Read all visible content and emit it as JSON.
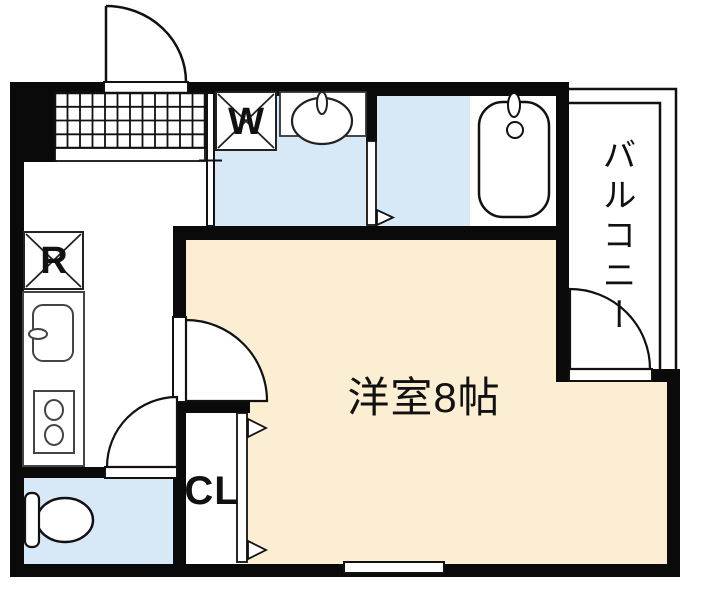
{
  "floorplan": {
    "labels": {
      "main_room": "洋室8帖",
      "balcony": "バルコニー",
      "washer": "W",
      "refrigerator": "R",
      "closet": "CL"
    },
    "colors": {
      "wall": "#0a0a0a",
      "water_area_floor": "#d7e9f6",
      "main_room_floor": "#fbeed2",
      "fixture_stroke": "#333333",
      "line": "#111111"
    }
  }
}
